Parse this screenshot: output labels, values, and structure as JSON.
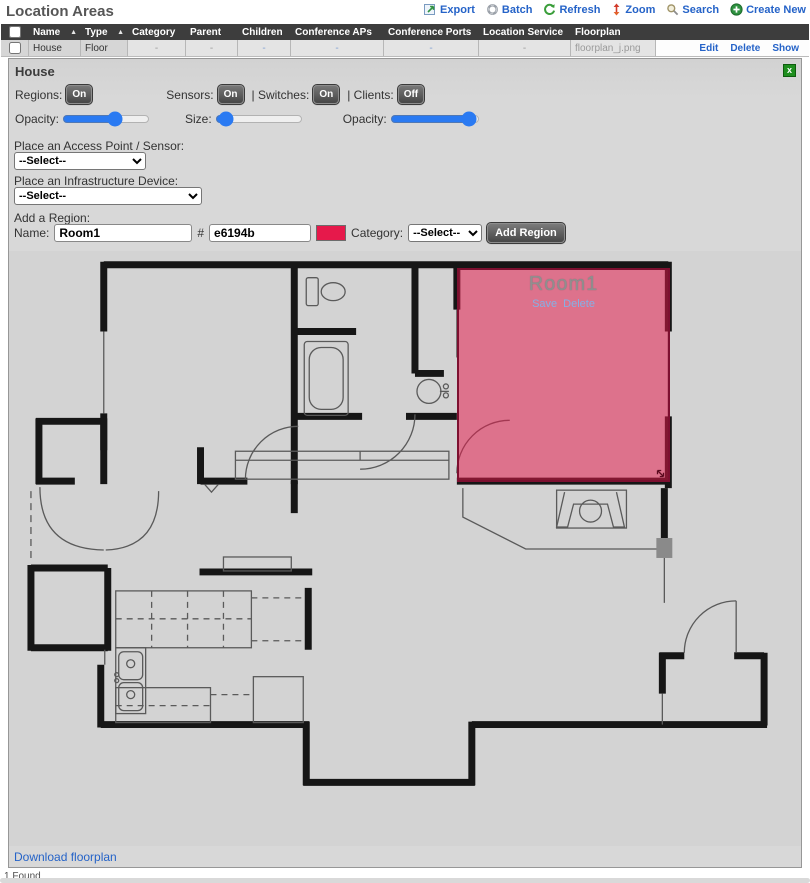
{
  "header": {
    "title": "Location Areas",
    "toolbar": [
      {
        "icon": "export-icon",
        "label": "Export"
      },
      {
        "icon": "batch-icon",
        "label": "Batch"
      },
      {
        "icon": "refresh-icon",
        "label": "Refresh"
      },
      {
        "icon": "zoom-icon",
        "label": "Zoom"
      },
      {
        "icon": "search-icon",
        "label": "Search"
      },
      {
        "icon": "create-new-icon",
        "label": "Create New"
      }
    ]
  },
  "table": {
    "columns": [
      "Name",
      "Type",
      "Category",
      "Parent",
      "Children",
      "Conference APs",
      "Conference Ports",
      "Location Service",
      "Floorplan"
    ],
    "sort_icon": "▲",
    "row": {
      "name": "House",
      "type": "Floor",
      "category": "-",
      "parent": "-",
      "children": "-",
      "conference_aps": "-",
      "conference_ports": "-",
      "location_service": "-",
      "floorplan": "floorplan_j.png"
    },
    "row_actions": [
      "Edit",
      "Delete",
      "Show"
    ]
  },
  "panel": {
    "title": "House",
    "close_label": "x",
    "toggles": {
      "regions_label": "Regions:",
      "regions_state": "On",
      "sensors_label": "Sensors:",
      "sensors_state": "On",
      "switches_label": "| Switches:",
      "switches_state": "On",
      "clients_label": "| Clients:",
      "clients_state": "Off"
    },
    "sliders": {
      "opacity1_label": "Opacity:",
      "opacity1_value": "62",
      "size_label": "Size:",
      "size_value": "5",
      "opacity2_label": "Opacity:",
      "opacity2_value": "97"
    },
    "place_ap": {
      "label": "Place an Access Point / Sensor:",
      "selected": "--Select--"
    },
    "place_infra": {
      "label": "Place an Infrastructure Device:",
      "selected": "--Select--"
    },
    "add_region": {
      "section_label": "Add a Region:",
      "name_label": "Name:",
      "name_value": "Room1",
      "hash_label": "#",
      "color_value": "e6194b",
      "swatch_color": "#e6194b",
      "category_label": "Category:",
      "category_selected": "--Select--",
      "button_label": "Add Region"
    },
    "download_link": "Download floorplan"
  },
  "floorplan_region": {
    "label": "Room1",
    "save_label": "Save",
    "delete_label": "Delete",
    "fill_color": "#e6194b"
  },
  "status_bar": {
    "found": "1 Found"
  }
}
